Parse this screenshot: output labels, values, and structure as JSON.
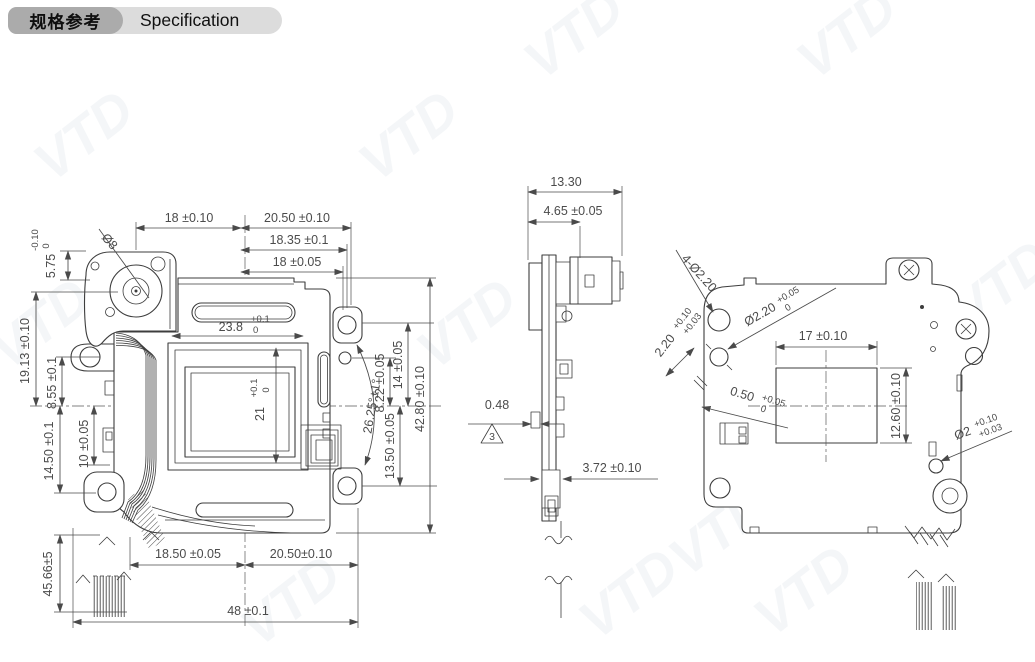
{
  "header": {
    "title_zh": "规格参考",
    "title_en": "Specification"
  },
  "watermark": {
    "text": "VTD"
  },
  "colors": {
    "line": "#3d3d3d",
    "dim_text": "#4b4b4b",
    "badge_dark": "#ababab",
    "badge_light": "#dcdcdc",
    "watermark": "#8ea3b8"
  },
  "drawing": {
    "front": {
      "labels": {
        "top1": "18 ±0.10",
        "top2": "20.50 ±0.10",
        "top3": "18.35 ±0.1",
        "top4": "18 ±0.05",
        "slot_w": "23.8",
        "slot_w_u": "+0.1",
        "slot_w_l": "0",
        "ap_h": "21",
        "ap_h_u": "+0.1",
        "ap_h_l": "0",
        "motor_dia": "Ø8",
        "l1": "5.75",
        "l1_u": "0",
        "l1_l": "-0.10",
        "l2": "19.13 ±0.10",
        "l3": "8.55 ±0.1",
        "l4": "10 ±0.05",
        "l5": "14.50 ±0.1",
        "l6": "45.66±5",
        "r1": "14 ±0.05",
        "r2": "8.22 ±0.05",
        "r3": "26.25°±1°",
        "r4": "13.50 ±0.05",
        "r5": "42.80 ±0.10",
        "b1": "18.50 ±0.05",
        "b2": "20.50±0.10",
        "b3": "48 ±0.1"
      }
    },
    "side": {
      "labels": {
        "t1": "13.30",
        "t2": "4.65 ±0.05",
        "m1": "0.48",
        "note": "3",
        "b1": "3.72 ±0.10"
      }
    },
    "back": {
      "labels": {
        "holes": "4-Ø2.20",
        "hole2": "Ø2.20",
        "hole2_u": "+0.05",
        "hole2_l": "0",
        "off1": "2.20",
        "off1_u": "+0.10",
        "off1_l": "+0.03",
        "off2": "0.50",
        "off2_u": "+0.05",
        "off2_l": "0",
        "ap_w": "17 ±0.10",
        "ap_h": "12.60 ±0.10",
        "hole3": "Ø2",
        "hole3_u": "+0.10",
        "hole3_l": "+0.03"
      }
    }
  }
}
